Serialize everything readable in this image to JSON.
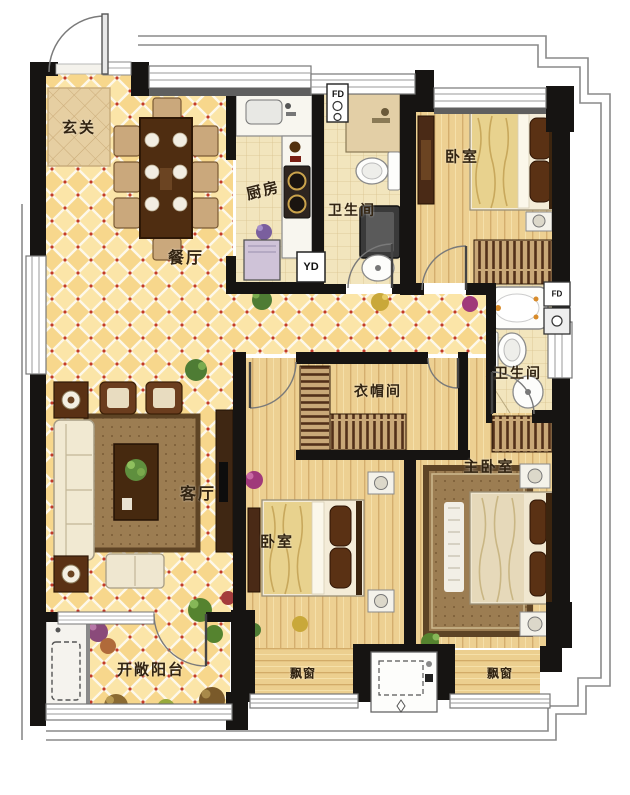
{
  "title": "三室两厅两卫户型平面图",
  "rooms": {
    "foyer": {
      "label": "玄关"
    },
    "dining": {
      "label": "餐厅"
    },
    "kitchen": {
      "label": "厨房"
    },
    "bath1": {
      "label": "卫生间"
    },
    "bedroom_top": {
      "label": "卧室"
    },
    "bath2": {
      "label": "卫生间"
    },
    "cloakroom": {
      "label": "衣帽间"
    },
    "living": {
      "label": "客厅"
    },
    "bedroom_mid": {
      "label": "卧室"
    },
    "master": {
      "label": "主卧室"
    },
    "balcony": {
      "label": "开敞阳台"
    },
    "bay_left": {
      "label": "飘窗"
    },
    "bay_right": {
      "label": "飘窗"
    }
  },
  "fixtures": {
    "fd_top": {
      "label": "FD"
    },
    "yd": {
      "label": "YD"
    },
    "fd_right": {
      "label": "FD"
    }
  },
  "palette": {
    "wall": "#161412",
    "gold_tile": "#f7d78c",
    "wood": "#edd092",
    "bath_tile": "#f2e5bd",
    "red_dot": "#c23b28",
    "furniture_brown": "#4a2a16",
    "contour_gray": "#8a8a8a"
  }
}
